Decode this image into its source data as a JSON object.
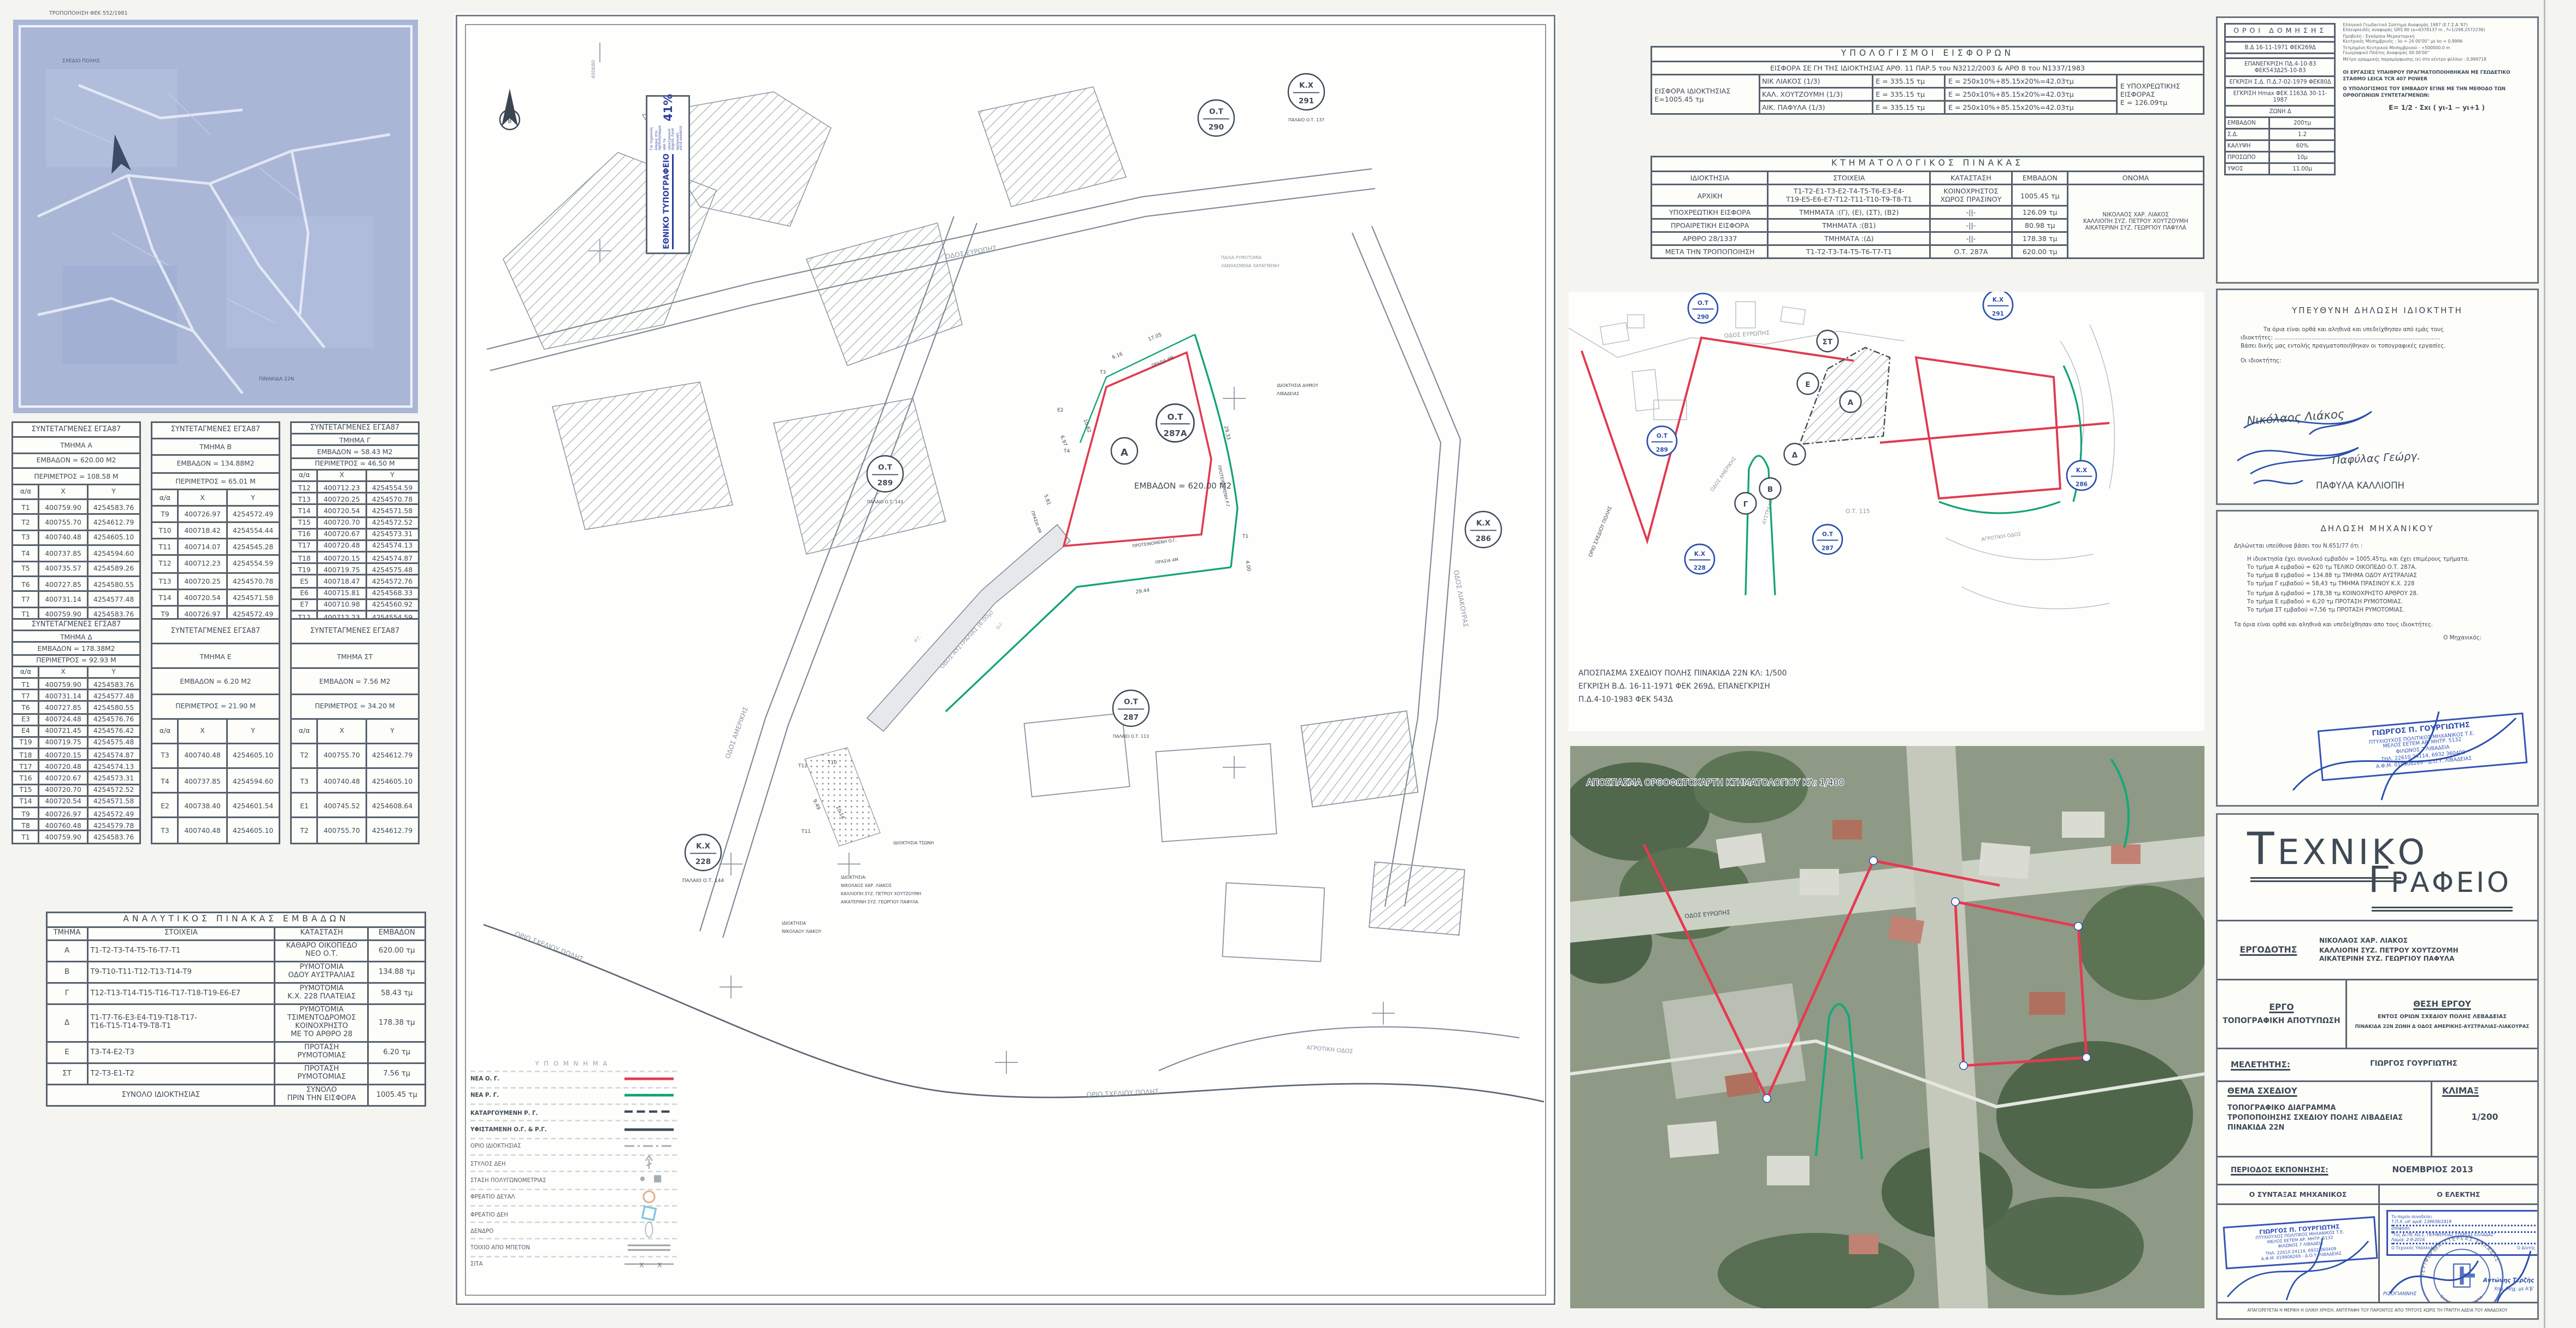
{
  "blueprint": {
    "caption": "ΤΡΟΠΟΠΟΙΗΣΗ ΦΕΚ 552/1981"
  },
  "coord_tables": [
    {
      "title": "ΣΥΝΤΕΤΑΓΜΕΝΕΣ ΕΓΣΑ87",
      "section": "ΤΜΗΜΑ Α",
      "area": "ΕΜΒΑΔΟΝ = 620.00 Μ2",
      "perimeter": "ΠΕΡΙΜΕΤΡΟΣ = 108.58 Μ",
      "cols": [
        "α/α",
        "Χ",
        "Υ"
      ],
      "rows": [
        [
          "Τ1",
          "400759.90",
          "4254583.76"
        ],
        [
          "Τ2",
          "400755.70",
          "4254612.79"
        ],
        [
          "Τ3",
          "400740.48",
          "4254605.10"
        ],
        [
          "Τ4",
          "400737.85",
          "4254594.60"
        ],
        [
          "Τ5",
          "400735.57",
          "4254589.26"
        ],
        [
          "Τ6",
          "400727.85",
          "4254580.55"
        ],
        [
          "Τ7",
          "400731.14",
          "4254577.48"
        ],
        [
          "Τ1",
          "400759.90",
          "4254583.76"
        ]
      ]
    },
    {
      "title": "ΣΥΝΤΕΤΑΓΜΕΝΕΣ ΕΓΣΑ87",
      "section": "ΤΜΗΜΑ Β",
      "area": "ΕΜΒΑΔΟΝ = 134.88Μ2",
      "perimeter": "ΠΕΡΙΜΕΤΡΟΣ = 65.01 Μ",
      "cols": [
        "α/α",
        "Χ",
        "Υ"
      ],
      "rows": [
        [
          "Τ9",
          "400726.97",
          "4254572.49"
        ],
        [
          "Τ10",
          "400718.42",
          "4254554.44"
        ],
        [
          "Τ11",
          "400714.07",
          "4254545.28"
        ],
        [
          "Τ12",
          "400712.23",
          "4254554.59"
        ],
        [
          "Τ13",
          "400720.25",
          "4254570.78"
        ],
        [
          "Τ14",
          "400720.54",
          "4254571.58"
        ],
        [
          "Τ9",
          "400726.97",
          "4254572.49"
        ]
      ]
    },
    {
      "title": "ΣΥΝΤΕΤΑΓΜΕΝΕΣ ΕΓΣΑ87",
      "section": "ΤΜΗΜΑ Γ",
      "area": "ΕΜΒΑΔΟΝ = 58.43 Μ2",
      "perimeter": "ΠΕΡΙΜΕΤΡΟΣ = 46.50 Μ",
      "cols": [
        "α/α",
        "Χ",
        "Υ"
      ],
      "rows": [
        [
          "Τ12",
          "400712.23",
          "4254554.59"
        ],
        [
          "Τ13",
          "400720.25",
          "4254570.78"
        ],
        [
          "Τ14",
          "400720.54",
          "4254571.58"
        ],
        [
          "Τ15",
          "400720.70",
          "4254572.52"
        ],
        [
          "Τ16",
          "400720.67",
          "4254573.31"
        ],
        [
          "Τ17",
          "400720.48",
          "4254574.13"
        ],
        [
          "Τ18",
          "400720.15",
          "4254574.87"
        ],
        [
          "Τ19",
          "400719.75",
          "4254575.48"
        ],
        [
          "Ε5",
          "400718.47",
          "4254572.76"
        ],
        [
          "Ε6",
          "400715.81",
          "4254568.33"
        ],
        [
          "Ε7",
          "400710.98",
          "4254560.92"
        ],
        [
          "Τ12",
          "400712.23",
          "4254554.59"
        ]
      ]
    },
    {
      "title": "ΣΥΝΤΕΤΑΓΜΕΝΕΣ ΕΓΣΑ87",
      "section": "ΤΜΗΜΑ Δ",
      "area": "ΕΜΒΑΔΟΝ = 178.38Μ2",
      "perimeter": "ΠΕΡΙΜΕΤΡΟΣ = 92.93 Μ",
      "cols": [
        "α/α",
        "Χ",
        "Υ"
      ],
      "rows": [
        [
          "Τ1",
          "400759.90",
          "4254583.76"
        ],
        [
          "Τ7",
          "400731.14",
          "4254577.48"
        ],
        [
          "Τ6",
          "400727.85",
          "4254580.55"
        ],
        [
          "Ε3",
          "400724.48",
          "4254576.76"
        ],
        [
          "Ε4",
          "400721.45",
          "4254576.42"
        ],
        [
          "Τ19",
          "400719.75",
          "4254575.48"
        ],
        [
          "Τ18",
          "400720.15",
          "4254574.87"
        ],
        [
          "Τ17",
          "400720.48",
          "4254574.13"
        ],
        [
          "Τ16",
          "400720.67",
          "4254573.31"
        ],
        [
          "Τ15",
          "400720.70",
          "4254572.52"
        ],
        [
          "Τ14",
          "400720.54",
          "4254571.58"
        ],
        [
          "Τ9",
          "400726.97",
          "4254572.49"
        ],
        [
          "Τ8",
          "400760.48",
          "4254579.78"
        ],
        [
          "Τ1",
          "400759.90",
          "4254583.76"
        ]
      ]
    },
    {
      "title": "ΣΥΝΤΕΤΑΓΜΕΝΕΣ ΕΓΣΑ87",
      "section": "ΤΜΗΜΑ Ε",
      "area": "ΕΜΒΑΔΟΝ = 6.20 Μ2",
      "perimeter": "ΠΕΡΙΜΕΤΡΟΣ = 21.90 Μ",
      "cols": [
        "α/α",
        "Χ",
        "Υ"
      ],
      "rows": [
        [
          "Τ3",
          "400740.48",
          "4254605.10"
        ],
        [
          "Τ4",
          "400737.85",
          "4254594.60"
        ],
        [
          "Ε2",
          "400738.40",
          "4254601.54"
        ],
        [
          "Τ3",
          "400740.48",
          "4254605.10"
        ]
      ]
    },
    {
      "title": "ΣΥΝΤΕΤΑΓΜΕΝΕΣ ΕΓΣΑ87",
      "section": "ΤΜΗΜΑ ΣΤ",
      "area": "ΕΜΒΑΔΟΝ = 7.56 Μ2",
      "perimeter": "ΠΕΡΙΜΕΤΡΟΣ = 34.20 Μ",
      "cols": [
        "α/α",
        "Χ",
        "Υ"
      ],
      "rows": [
        [
          "Τ2",
          "400755.70",
          "4254612.79"
        ],
        [
          "Τ3",
          "400740.48",
          "4254605.10"
        ],
        [
          "Ε1",
          "400745.52",
          "4254608.64"
        ],
        [
          "Τ2",
          "400755.70",
          "4254612.79"
        ]
      ]
    }
  ],
  "areas_table": {
    "title": "ΑΝΑΛΥΤΙΚΟΣ ΠΙΝΑΚΑΣ ΕΜΒΑΔΩΝ",
    "headers": [
      "ΤΜΗΜΑ",
      "ΣΤΟΙΧΕΙΑ",
      "ΚΑΤΑΣΤΑΣΗ",
      "ΕΜΒΑΔΟΝ"
    ],
    "rows": [
      [
        "Α",
        "Τ1-Τ2-Τ3-Τ4-Τ5-Τ6-Τ7-Τ1",
        "ΚΑΘΑΡΟ ΟΙΚΟΠΕΔΟ\nΝΕΟ Ο.Τ.",
        "620.00 τμ"
      ],
      [
        "Β",
        "Τ9-Τ10-Τ11-Τ12-Τ13-Τ14-Τ9",
        "ΡΥΜΟΤΟΜΙΑ\nΟΔΟΥ ΑΥΣΤΡΑΛΙΑΣ",
        "134.88 τμ"
      ],
      [
        "Γ",
        "Τ12-Τ13-Τ14-Τ15-Τ16-Τ17-Τ18-Τ19-Ε6-Ε7",
        "ΡΥΜΟΤΟΜΙΑ\nΚ.Χ. 228 ΠΛΑΤΕΙΑΣ",
        "58.43 τμ"
      ],
      [
        "Δ",
        "Τ1-Τ7-Τ6-Ε3-Ε4-Τ19-Τ18-Τ17-\nΤ16-Τ15-Τ14-Τ9-Τ8-Τ1",
        "ΡΥΜΟΤΟΜΙΑ\nΤΣΙΜΕΝΤΟΔΡΟΜΟΣ\nΚΟΙΝΟΧΡΗΣΤΟ\nΜΕ ΤΟ ΑΡΘΡΟ 28",
        "178.38 τμ"
      ],
      [
        "Ε",
        "Τ3-Τ4-Ε2-Τ3",
        "ΠΡΟΤΑΣΗ\nΡΥΜΟΤΟΜΙΑΣ",
        "6.20 τμ"
      ],
      [
        "ΣΤ",
        "Τ2-Τ3-Ε1-Τ2",
        "ΠΡΟΤΑΣΗ\nΡΥΜΟΤΟΜΙΑΣ",
        "7.56 τμ"
      ]
    ],
    "footer": [
      "ΣΥΝΟΛΟ ΙΔΙΟΚΤΗΣΙΑΣ",
      "ΣΥΝΟΛΟ\nΠΡΙΝ ΤΗΝ ΕΙΣΦΟΡΑ",
      "1005.45 τμ"
    ]
  },
  "contrib_table": {
    "title": "ΥΠΟΛΟΓΙΣΜΟΙ ΕΙΣΦΟΡΩΝ",
    "subtitle": "ΕΙΣΦΟΡΑ ΣΕ ΓΗ ΤΗΣ ΙΔΙΟΚΤΗΣΙΑΣ ΑΡΘ. 11 ΠΑΡ.5 του Ν3212/2003 & ΑΡΘ 8 του Ν1337/1983",
    "left_label": "ΕΙΣΦΟΡΑ ΙΔΙΟΚΤΗΣΙΑΣ\nΕ=1005.45 τμ",
    "rows": [
      [
        "ΝΙΚ ΛΙΑΚΟΣ (1/3)",
        "Ε = 335.15 τμ",
        "Ε = 250x10%+85.15x20%=42.03τμ"
      ],
      [
        "ΚΑΛ. ΧΟΥΤΖΟΥΜΗ (1/3)",
        "Ε = 335.15 τμ",
        "Ε = 250x10%+85.15x20%=42.03τμ"
      ],
      [
        "ΑΙΚ. ΠΑΦΥΛΑ (1/3)",
        "Ε = 335.15 τμ",
        "Ε = 250x10%+85.15x20%=42.03τμ"
      ]
    ],
    "right_label": "Ε ΥΠΟΧΡΕΩΤΙΚΗΣ\nΕΙΣΦΟΡΑΣ\nΕ = 126.09τμ"
  },
  "cadastral_table": {
    "title": "ΚΤΗΜΑΤΟΛΟΓΙΚΟΣ ΠΙΝΑΚΑΣ",
    "headers": [
      "ΙΔΙΟΚΤΗΣΙΑ",
      "ΣΤΟΙΧΕΙΑ",
      "ΚΑΤΑΣΤΑΣΗ",
      "ΕΜΒΑΔΟΝ",
      "ΟΝΟΜΑ"
    ],
    "rows": [
      [
        "ΑΡΧΙΚΗ",
        "Τ1-Τ2-Ε1-Τ3-Ε2-Τ4-Τ5-Τ6-Ε3-Ε4-\nΤ19-Ε5-Ε6-Ε7-Τ12-Τ11-Τ10-Τ9-Τ8-Τ1",
        "ΚΟΙΝΟΧΡΗΣΤΟΣ\nΧΩΡΟΣ ΠΡΑΣΙΝΟΥ",
        "1005.45 τμ"
      ],
      [
        "ΥΠΟΧΡΕΩΤΙΚΗ ΕΙΣΦΟΡΑ",
        "ΤΜΗΜΑΤΑ :(Γ), (Ε), (ΣΤ), (Β2)",
        "-||-",
        "126.09 τμ"
      ],
      [
        "ΠΡΟΑΙΡΕΤΙΚΗ ΕΙΣΦΟΡΑ",
        "ΤΜΗΜΑΤΑ :(Β1)",
        "-||-",
        "80.98 τμ"
      ],
      [
        "ΑΡΘΡΟ 28/1337",
        "ΤΜΗΜΑΤΑ :(Δ)",
        "-||-",
        "178.38 τμ"
      ],
      [
        "ΜΕΤΑ ΤΗΝ ΤΡΟΠΟΠΟΙΗΣΗ",
        "Τ1-Τ2-Τ3-Τ4-Τ5-Τ6-Τ7-Τ1",
        "Ο.Τ. 287Α",
        "620.00 τμ"
      ]
    ],
    "name": "ΝΙΚΟΛΑΟΣ ΧΑΡ. ΛΙΑΚΟΣ\nΚΑΛΛΙΟΠΗ ΣΥΖ. ΠΕΤΡΟΥ ΧΟΥΤΖΟΥΜΗ\nΑΙΚΑΤΕΡΙΝΗ ΣΥΖ. ΓΕΩΡΓΙΟΥ ΠΑΦΥΛΑ"
  },
  "main_plan": {
    "north_letter": "Β",
    "grid_label": "400680",
    "reduction_box": {
      "title": "ΕΘΝΙΚΟ ΤΥΠΟΓΡΑΦΕΙΟ",
      "body": "Για τεχνικούς λόγους στο σχεδιάγραμμα, από το ηλεκτρονικό αρχείο, έγινε σμίκρυνση κατά ποσοστό",
      "percent": "41%"
    },
    "plot_letter": "Α",
    "area_label": "ΕΜΒΑΔΟΝ = 620.00 Μ2",
    "circles": [
      {
        "t": "Ο.Τ",
        "b": "290",
        "note": ""
      },
      {
        "t": "Κ.Χ",
        "b": "291",
        "note": "ΠΑΛΑΙΟ Ο.Τ. 137"
      },
      {
        "t": "Ο.Τ",
        "b": "289",
        "note": "ΠΑΛΑΙΟ Ο.Τ. 143"
      },
      {
        "t": "Κ.Χ",
        "b": "228",
        "note": "ΠΑΛΑΙΟ Ο.Τ. 144"
      },
      {
        "t": "Ο.Τ",
        "b": "287",
        "note": "ΠΑΛΑΙΟ Ο.Τ. 113"
      },
      {
        "t": "Κ.Χ",
        "b": "286",
        "note": ""
      },
      {
        "t": "Ο.Τ",
        "b": "287Α",
        "note": ""
      }
    ],
    "streets": [
      "ΟΔΟΣ ΕΥΡΩΠΗΣ",
      "ΟΔΟΣ ΑΜΕΡΙΚΗΣ",
      "ΟΔΟΣ ΑΥΣΤΡΑΛΙΑΣ (6.00μ)",
      "ΟΔΟΣ ΛΙΑΚΟΥΡΑΣ",
      "ΑΓΡΟΤΙΚΗ ΟΔΟΣ"
    ],
    "line_labels": [
      "ΠΡΟΤΕΙΝΟΜΕΝΗ Ο.Γ.",
      "ΠΡΟΤΕΙΝΟΜΕΝΗ Ρ.Γ.",
      "ΠΡΑΣΙΑ 4Μ",
      "Ρ.Γ.",
      "Ο.Γ.",
      "ΟΡΙΟ ΣΧΕΔΙΟΥ ΠΟΛΗΣ",
      "ΠΑΛΙΑ ΡΥΜΟΤΟΜΙΑ",
      "ΛΑΝΘΑΣΜΕΝΑ ΧΑΡΑΓΜΕΝΗ"
    ],
    "points": [
      "Τ3",
      "Τ4",
      "Ε2",
      "Τ1",
      "Τ12",
      "Τ10",
      "Τ11"
    ],
    "dims": [
      "17.05",
      "6.16",
      "10.82",
      "6.97",
      "5.81",
      "29.33",
      "4.00",
      "29.44",
      "9.49",
      "10.14"
    ],
    "owners": [
      "ΙΔΙΟΚΤΗΣΙΑ ΔΗΜΟΥ",
      "ΛΙΒΑΔΕΙΑΣ",
      "ΙΔΙΟΚΤΗΣΙΑ ΤΣΩΝΗ",
      "ΙΔΙΟΚΤΗΣΙΑ:",
      "ΝΙΚΟΛΑΟΣ ΧΑΡ. ΛΙΑΚΟΣ",
      "ΚΑΛΛΙΟΠΗ ΣΥΖ. ΠΕΤΡΟΥ ΧΟΥΤΖΟΥΜΗ",
      "ΑΙΚΑΤΕΡΙΝΗ ΣΥΖ. ΓΕΩΡΓΙΟΥ ΠΑΦΥΛΑ",
      "ΙΔΙΟΚΤΗΣΙΑ",
      "ΝΙΚΟΛΑΟΥ ΛΙΑΚΟΥ"
    ],
    "legend": {
      "title": "ΥΠΟΜΝΗΜΑ",
      "items": [
        {
          "label": "ΝΕΑ Ο. Γ.",
          "kind": "line",
          "color": "#e03a50",
          "strong": true
        },
        {
          "label": "ΝΕΑ Ρ. Γ.",
          "kind": "line",
          "color": "#12a376",
          "strong": true
        },
        {
          "label": "ΚΑΤΑΡΓΟΥΜΕΝΗ Ρ. Γ.",
          "kind": "dashed",
          "color": "#3e4a56",
          "strong": true
        },
        {
          "label": "ΥΦΙΣΤΑΜΕΝΗ Ο.Γ. & Ρ.Γ.",
          "kind": "line",
          "color": "#3e4a56",
          "strong": true
        },
        {
          "label": "ΟΡΙΟ ΙΔΙΟΚΤΗΣΙΑΣ",
          "kind": "dashdot",
          "color": "#6b7683",
          "strong": false
        },
        {
          "label": "ΣΤΥΛΟΣ ΔΕΗ",
          "kind": "pole",
          "color": "#6b7683",
          "strong": false
        },
        {
          "label": "ΣΤΑΣΗ ΠΟΛΥΓΩΝΟΜΕΤΡΙΑΣ",
          "kind": "station",
          "color": "#6b7683",
          "strong": false
        },
        {
          "label": "ΦΡΕΑΤΙΟ ΔΕΥΑΛ",
          "kind": "circle",
          "color": "#c87a45",
          "strong": false
        },
        {
          "label": "ΦΡΕΑΤΙΟ ΔΕΗ",
          "kind": "square",
          "color": "#2aa0c8",
          "strong": false
        },
        {
          "label": "ΔΕΝΔΡΟ",
          "kind": "tree",
          "color": "#8d99a5",
          "strong": false
        },
        {
          "label": "ΤΟΙΧΙΟ ΑΠΟ ΜΠΕΤΟΝ",
          "kind": "double",
          "color": "#5b6672",
          "strong": false
        },
        {
          "label": "ΣΙΤΑ",
          "kind": "xline",
          "color": "#5b6672",
          "strong": false
        }
      ]
    }
  },
  "excerpt_plan": {
    "labels": {
      "ot290": [
        "Ο.Τ",
        "290"
      ],
      "ot289": [
        "Ο.Τ",
        "289"
      ],
      "kx228": [
        "Κ.Χ",
        "228"
      ],
      "ot287": [
        "Ο.Τ",
        "287"
      ],
      "kx291": [
        "Κ.Χ",
        "291"
      ],
      "kx286": [
        "Κ.Χ",
        "286"
      ],
      "ot115": "Ο.Τ. 115",
      "street_europe": "ΟΔΟΣ ΕΥΡΩΠΗΣ",
      "street_america": "ΟΔΟΣ ΑΜΕΡΙΚΗΣ",
      "street_australia": "ΑΥΣΤΡΑΛΙΑΣ",
      "street_rural": "ΑΓΡΟΤΙΚΗ ΟΔΟΣ",
      "boundary": "ΟΡΙΟ ΣΧΕΔΙΟΥ ΠΟΛΗΣ"
    },
    "letters": [
      "ΣΤ",
      "Ε",
      "Α",
      "Δ",
      "Β",
      "Γ"
    ],
    "caption": [
      "ΑΠΟΣΠΑΣΜΑ ΣΧΕΔΙΟΥ ΠΟΛΗΣ ΠΙΝΑΚΙΔΑ 22Ν ΚΛ: 1/500",
      "ΕΓΚΡΙΣΗ Β.Δ. 16-11-1971 ΦΕΚ 269Δ, ΕΠΑΝΕΓΚΡΙΣΗ",
      "Π.Δ.4-10-1983 ΦΕΚ 543Δ"
    ]
  },
  "orthophoto": {
    "caption": "ΑΠΟΣΠΑΣΜΑ ΟΡΘΟΦΩΤΟΧΑΡΤΗ ΚΤΗΜΑΤΟΛΟΓΙΟΥ ΚΛ: 1/400",
    "street": "ΟΔΟΣ ΕΥΡΩΠΗΣ"
  },
  "building_terms": {
    "title": "ΟΡΟΙ ΔΟΜΗΣΗΣ",
    "rows": [
      "",
      "Β.Δ 16-11-1971 ΦΕΚ269Δ",
      "",
      "ΕΠΑΝΕΓΚΡΙΣΗ ΠΔ.4-10-83 ΦΕΚ543Δ25-10-83",
      "ΕΓΚΡΙΣΗ Σ.Δ. Π.Δ.7-02-1979 ΦΕΚ80Δ",
      "ΕΓΚΡΙΣΗ Hmax ΦΕΚ 1163Δ 30-11-1987",
      "ΖΩΝΗ Δ"
    ],
    "pairs": [
      [
        "ΕΜΒΑΔΟΝ",
        "200τμ"
      ],
      [
        "Σ.Δ.",
        "1.2"
      ],
      [
        "ΚΑΛΥΨΗ",
        "60%"
      ],
      [
        "ΠΡΟΣΩΠΟ",
        "10μ"
      ],
      [
        "ΥΨΟΣ",
        "11.00μ"
      ]
    ]
  },
  "geodetic_notes": [
    "Ελληνικό Γεωδαιτικό Σύστημα Αναφοράς 1987 (Ε.Γ.Σ.Α.'87)",
    "Ελλειψοειδές αναφοράς GRS 80 (a=6378137 m , f=1/298.2572236)",
    "Προβολή : Εγκάρσια Μερκατορική",
    "Κεντρικός Μεσημβρινός : λο = 24 00'00'' με ko = 0,9996",
    "Τετμημένη Κεντρικού Μεσημβρινού : +500000.0 m",
    "Γεωγραφικό Πλάτος Αναφοράς 00 00'00''",
    "Μέτρο γραμμικής παραμόρφωσης (κ) στο κέντρο φύλλου : 0,999718"
  ],
  "field_notes": [
    "ΟΙ ΕΡΓΑΣΙΕΣ ΥΠΑΙΘΡΟΥ ΠΡΑΓΜΑΤΟΠΟΙΗΘΗΚΑΝ ΜΕ ΓΕΩΔΕΤΙΚΟ ΣΤΑΘΜΟ  LEICA  TCR 407 POWER",
    "Ο ΥΠΟΛΟΓΙΣΜΟΣ ΤΟΥ ΕΜΒΑΔΟΥ ΕΓΙΝΕ ΜΕ ΤΗΝ ΜΕΘΟΔΟ ΤΩΝ ΟΡΘΟΓΩΝΙΩΝ ΣΥΝΤΕΤΑΓΜΕΝΩΝ:"
  ],
  "formula": "Ε= 1/2 · Σxι ( yι-1 − yι+1 )",
  "owner_declaration": {
    "title": "ΥΠΕΥΘΥΝΗ  ΔΗΛΩΣΗ ΙΔΙΟΚΤΗΤΗ",
    "line1": "Τα όρια είναι ορθά και αληθινά και υπεδείχθησαν από εμάς τους",
    "line2": "ιδιοκτήτες: ..............................................................................................",
    "line3": "Βάσει δικής μας εντολής πραγματοποιήθηκαν οι τοπογραφικές εργασίες.",
    "signer_label": "Οι ιδιοκτήτης:",
    "signatures": [
      "Νικόλαος Λιάκος",
      "Παφύλας Γεώργ.",
      "ΠΑΦΥΛΑ ΚΑΛΛΙΟΠΗ"
    ]
  },
  "engineer_declaration": {
    "title": "ΔΗΛΩΣΗ ΜΗΧΑΝΙΚΟΥ",
    "intro": "Δηλώνεται υπεύθυνα βάσει του Ν.651/77  ότι :",
    "lines": [
      "Η ιδιοκτησία έχει συνολικό εμβαδόν = 1005,45τμ, και έχει επιμέρους τμήματα.",
      "Το τμήμα Α   εμβαδού = 620 τμ ΤΕΛΙΚΟ ΟΙΚΟΠΕΔΟ Ο.Τ. 287Α.",
      "Το τμήμα Β   εμβαδού = 134.88 τμ ΤΜΗΜΑ ΟΔΟΥ ΑΥΣΤΡΑΛΙΑΣ",
      "Το τμήμα Γ   εμβαδού = 58,43 τμ  ΤΜΗΜΑ ΠΡΑΣΙΝΟΥ Κ.Χ. 228",
      "Το τμήμα Δ   εμβαδού = 178,38 τμ ΚΟΙΝΟΧΡΗΣΤΟ ΑΡΘΡΟΥ 28.",
      "Το τμήμα Ε   εμβαδού = 6,20 τμ ΠΡΟΤΑΣΗ ΡΥΜΟΤΟΜΙΑΣ.",
      "Το τμήμα ΣΤ  εμβαδού =7,56 τμ ΠΡΟΤΑΣΗ ΡΥΜΟΤΟΜΙΑΣ."
    ],
    "closing": "Τα όρια  είναι ορθά και αληθινά και  υπεδείχθησαν απο τους ιδιοκτήτες.",
    "signer_label": "Ο Μηχανικός:",
    "stamp_lines": [
      "ΓΙΩΡΓΟΣ Π. ΓΟΥΡΓΙΩΤΗΣ",
      "ΠΤΥΧΙΟΥΧΟΣ ΠΟΛΙΤΙΚΟΣ ΜΗΧΑΝΙΚΟΣ Τ.Ε.",
      "ΜΕΛΟΣ ΕΕΤΕΜ   ΑΡ. ΜΗΤΡ. 5132",
      "ΦΙΛΩΝΟΣ 7 ΛΙΒΑΔΕΙΑ",
      "ΤΗΛ. 22610 24114, 6932 360409",
      "Α.Φ.Μ. 019908269 - Δ.Ο.Υ. ΛΙΒΑΔΕΙΑΣ"
    ]
  },
  "title_block": {
    "brand1": "ΤΕΧΝΙΚΟ",
    "brand2": "ΓΡΑΦΕΙΟ",
    "employer_label": "ΕΡΓΟΔΟΤΗΣ",
    "employer_lines": [
      "ΝΙΚΟΛΑΟΣ ΧΑΡ. ΛΙΑΚΟΣ",
      "ΚΑΛΛΙΟΠΗ ΣΥΖ. ΠΕΤΡΟΥ ΧΟΥΤΖΟΥΜΗ",
      "ΑΙΚΑΤΕΡΙΝΗ ΣΥΖ. ΓΕΩΡΓΙΟΥ ΠΑΦΥΛΑ"
    ],
    "project_label": "ΕΡΓΟ",
    "project": "ΤΟΠΟΓΡΑΦΙΚΗ ΑΠΟΤΥΠΩΣΗ",
    "location_label": "ΘΕΣΗ  ΕΡΓΟΥ",
    "location_lines": [
      "ΕΝΤΟΣ ΟΡΙΩΝ ΣΧΕΔΙΟΥ  ΠΟΛΗΣ ΛΕΒΑΔΕΙΑΣ",
      "ΠΙΝΑΚΙΔΑ 22Ν ΖΩΝΗ Δ ΟΔΟΣ ΑΜΕΡΙΚΗΣ-ΑΥΣΤΡΑΛΙΑΣ-ΛΙΑΚΟΥΡΑΣ"
    ],
    "designer_label": "ΜΕΛΕΤΗΤΗΣ:",
    "designer": "ΓΙΩΡΓΟΣ ΓΟΥΡΓΙΩΤΗΣ",
    "subject_label": "ΘΕΜΑ  ΣΧΕΔΙΟΥ",
    "subject_lines": [
      "ΤΟΠΟΓΡΑΦΙΚΟ ΔΙΑΓΡΑΜΜΑ",
      "ΤΡΟΠΟΠΟΙΗΣΗΣ ΣΧΕΔΙΟΥ ΠΟΛΗΣ ΛΙΒΑΔΕΙΑΣ",
      "ΠΙΝΑΚΙΔΑ 22Ν"
    ],
    "scale_label": "ΚΛΙΜΑΞ",
    "scale": "1/200",
    "period_label": "ΠΕΡΙΟΔΟΣ ΕΚΠΟΝΗΣΗΣ:",
    "period": "ΝΟΕΜΒΡΙΟΣ 2013",
    "author_label": "Ο ΣΥΝΤΑΞΑΣ  ΜΗΧΑΝΙΚΟΣ",
    "checker_label": "Ο ΕΛΕΚΤΗΣ",
    "approval_lines": [
      "Το παρόν συνοδεύει",
      "Τ.Π.Χ. υπ' αριθ. 139939/2419",
      "απόφαση",
      "\"Της ΔΙ.ΠΕ.ΧΩ.Σ. ΠΕΡΙΦΕΡΕΙΑΣ ΣΤΕΡΕΑΣ ΕΛΛΑΔΑΣ\"",
      "Λαμία: 2-9-2016"
    ],
    "approval_roles": [
      "Ο Τεχνικός Υπάλληλος",
      "Ο Δ/ντής"
    ],
    "approval_name": "Αντώνης Τερζής",
    "approval_title": "Χημ. Μηχ. με Α'β'",
    "approval_name2": "ΡΙΖΟΓΙΑΝΝΗΣ",
    "round_stamp": [
      "ΕΛΛΗΝΙΚΗ ΔΗΜΟΚΡΑΤΙΑ",
      "ΠΕΡΙΦΕΡΕΙΑ ΣΤΕΡΕΑΣ ΕΛΛΑΔΑΣ"
    ],
    "footer": "ΑΠΑΓΟΡΕΥΕΤΑΙ Η ΜΕΡΙΚΗ Η ΟΛΙΚΗ ΧΡΗΣΗ, ΑΝΤΙΓΡΑΦΗ ΤΟΥ ΠΑΡΟΝΤΟΣ ΑΠΟ ΤΡΙΤΟΥΣ ΧΩΡΙΣ ΤΗ ΓΡΑΠΤΗ ΑΔΕΙΑ ΤΟΥ ΑΝΑΔΟΧΟΥ"
  }
}
